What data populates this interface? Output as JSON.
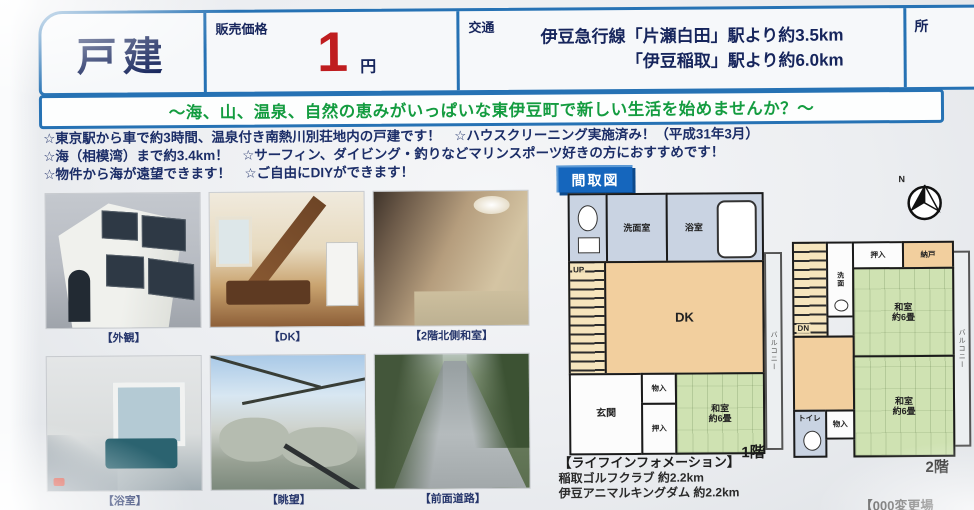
{
  "colors": {
    "accent_blue": "#2672b4",
    "price_red": "#bf1d1f",
    "banner_green": "#149c40",
    "text_navy": "#16255c",
    "badge_blue": "#1566bd"
  },
  "header": {
    "property_type": "戸建",
    "price": {
      "label": "販売価格",
      "value": "1",
      "unit": "円"
    },
    "transport": {
      "label": "交通",
      "line1": "伊豆急行線「片瀬白田」駅より約3.5km",
      "line2": "「伊豆稲取」駅より約6.0km"
    },
    "next_column_partial": "所"
  },
  "banner": {
    "text": "～海、山、温泉、自然の恵みがいっぱいな東伊豆町で新しい生活を始めませんか？～"
  },
  "highlights": [
    "☆東京駅から車で約3時間、温泉付き南熱川別荘地内の戸建です！　☆ハウスクリーニング実施済み！（平成31年3月）",
    "☆海（相模湾）まで約3.4km！　☆サーフィン、ダイビング・釣りなどマリンスポーツ好きの方におすすめです！",
    "☆物件から海が遠望できます！　☆ご自由にDIYができます！"
  ],
  "photos": {
    "captions": [
      "【外観】",
      "【DK】",
      "【2階北側和室】",
      "【浴室】",
      "【眺望】",
      "【前面道路】"
    ]
  },
  "floorplan": {
    "badge": "間取図",
    "compass": "N",
    "floor1": {
      "label": "1階",
      "rooms": {
        "senmenshitsu": "洗面室",
        "bathroom": "浴室",
        "up": "UP",
        "dk": "DK",
        "genkan": "玄関",
        "monoire": "物入",
        "oshiire": "押入",
        "washitsu": "和室\n約6畳",
        "balcony": "バルコニー"
      }
    },
    "floor2": {
      "label": "2階",
      "rooms": {
        "dn": "DN",
        "senmen": "洗面",
        "oshiire": "押入",
        "nando": "納戸",
        "washitsu_a": "和室\n約6畳",
        "washitsu_b": "和室\n約6畳",
        "monoire": "物入",
        "toilet": "トイレ",
        "balcony": "バルコニー"
      }
    }
  },
  "life_info": {
    "title": "【ライフインフォメーション】",
    "items": [
      "稲取ゴルフクラブ 約2.2km",
      "伊豆アニマルキングダム 約2.2km"
    ],
    "partial_note": "【000変更場"
  }
}
